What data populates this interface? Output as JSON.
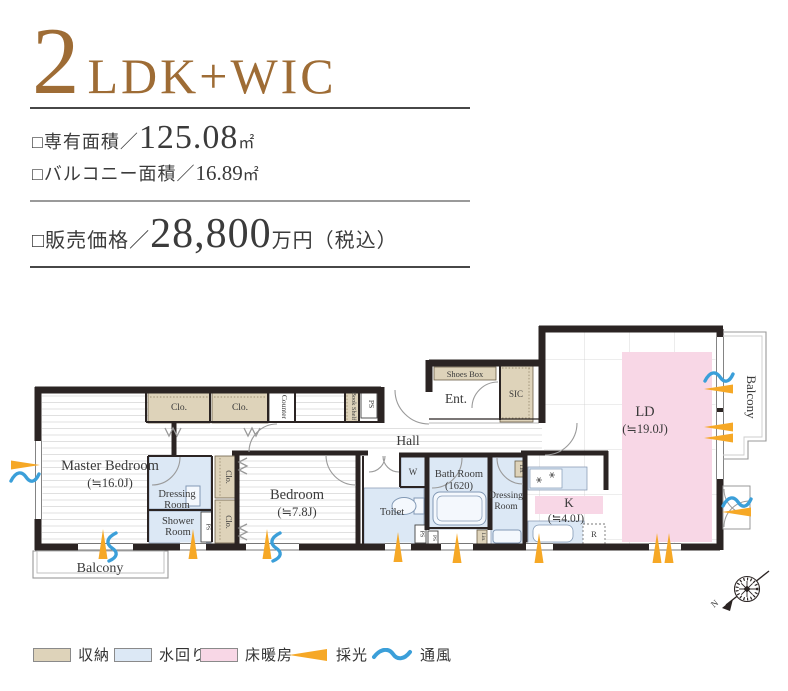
{
  "header": {
    "unit_number": "2",
    "unit_type": "LDK+WIC",
    "area_label": "□専有面積／",
    "area_value": "125.08",
    "area_unit": "㎡",
    "balcony_area_label": "□バルコニー面積／",
    "balcony_area_value": "16.89",
    "balcony_area_unit": "㎡",
    "price_label": "□販売価格／",
    "price_value": "28,800",
    "price_suffix": "万円（税込）"
  },
  "plan": {
    "master_bedroom": "Master Bedroom",
    "master_bedroom_size": "(≒16.0J)",
    "bedroom": "Bedroom",
    "bedroom_size": "(≒7.8J)",
    "ld": "LD",
    "ld_size": "(≒19.0J)",
    "k": "K",
    "k_size": "(≒4.0J)",
    "dressing_l1": "Dressing",
    "dressing_l2": "Room",
    "shower_l1": "Shower",
    "shower_l2": "Room",
    "bath_l1": "Bath Room",
    "bath_l2": "(1620)",
    "toilet": "Toilet",
    "hall": "Hall",
    "ent": "Ent.",
    "shoes_box": "Shoes Box",
    "sic": "SIC",
    "clo": "Clo.",
    "counter": "Counter",
    "book_shelf": "Book Shelf",
    "ps": "PS",
    "lin": "Lin.",
    "w": "W",
    "r": "R",
    "balcony": "Balcony",
    "compass_n": "N"
  },
  "legend": {
    "storage": "収納",
    "water": "水回り",
    "heating": "床暖房",
    "daylight": "採光",
    "wind": "通風"
  },
  "colors": {
    "accent": "#9e6c35",
    "wall": "#2b2423",
    "storage": "#ded3ba",
    "water": "#dce8f5",
    "floor_heating": "#f8d7e6",
    "daylight": "#f6a826",
    "wind": "#3b9fd9"
  }
}
